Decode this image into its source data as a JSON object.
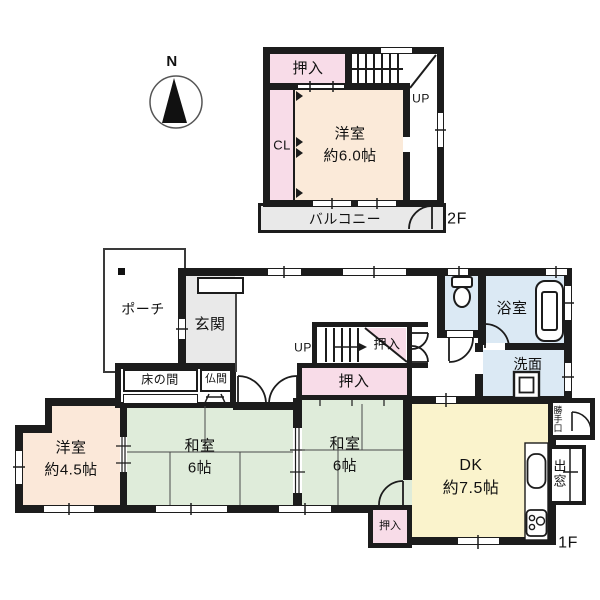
{
  "compass": {
    "north_label": "N"
  },
  "floor2": {
    "floor_label": "2F",
    "closet_oshiire": "押入",
    "closet_cl": "CL",
    "western_room_name": "洋室",
    "western_room_size": "約6.0帖",
    "stairs_label": "UP",
    "balcony": "バルコニー"
  },
  "floor1": {
    "floor_label": "1F",
    "porch": "ポーチ",
    "entrance": "玄関",
    "tokonoma": "床の間",
    "butsuma": "仏間",
    "stairs_label": "UP",
    "closet_by_stairs": "押入",
    "closet_center": "押入",
    "closet_south": "押入",
    "western_room_name": "洋室",
    "western_room_size": "約4.5帖",
    "japanese_room_west_name": "和室",
    "japanese_room_west_size": "6帖",
    "japanese_room_east_name": "和室",
    "japanese_room_east_size": "6帖",
    "dining_kitchen_name": "DK",
    "dining_kitchen_size": "約7.5帖",
    "bathroom": "浴室",
    "washroom": "洗面",
    "back_door": "勝手口",
    "bay_window": "出窓"
  },
  "colors": {
    "wall": "#1c1c1c",
    "closet_pink": "#f8dce8",
    "western_room_cream": "#fbead9",
    "tatami_green": "#dfecda",
    "dk_yellow": "#faf3cc",
    "wet_area_blue": "#dbe9f4",
    "entrance_gray": "#e9e9e9"
  }
}
